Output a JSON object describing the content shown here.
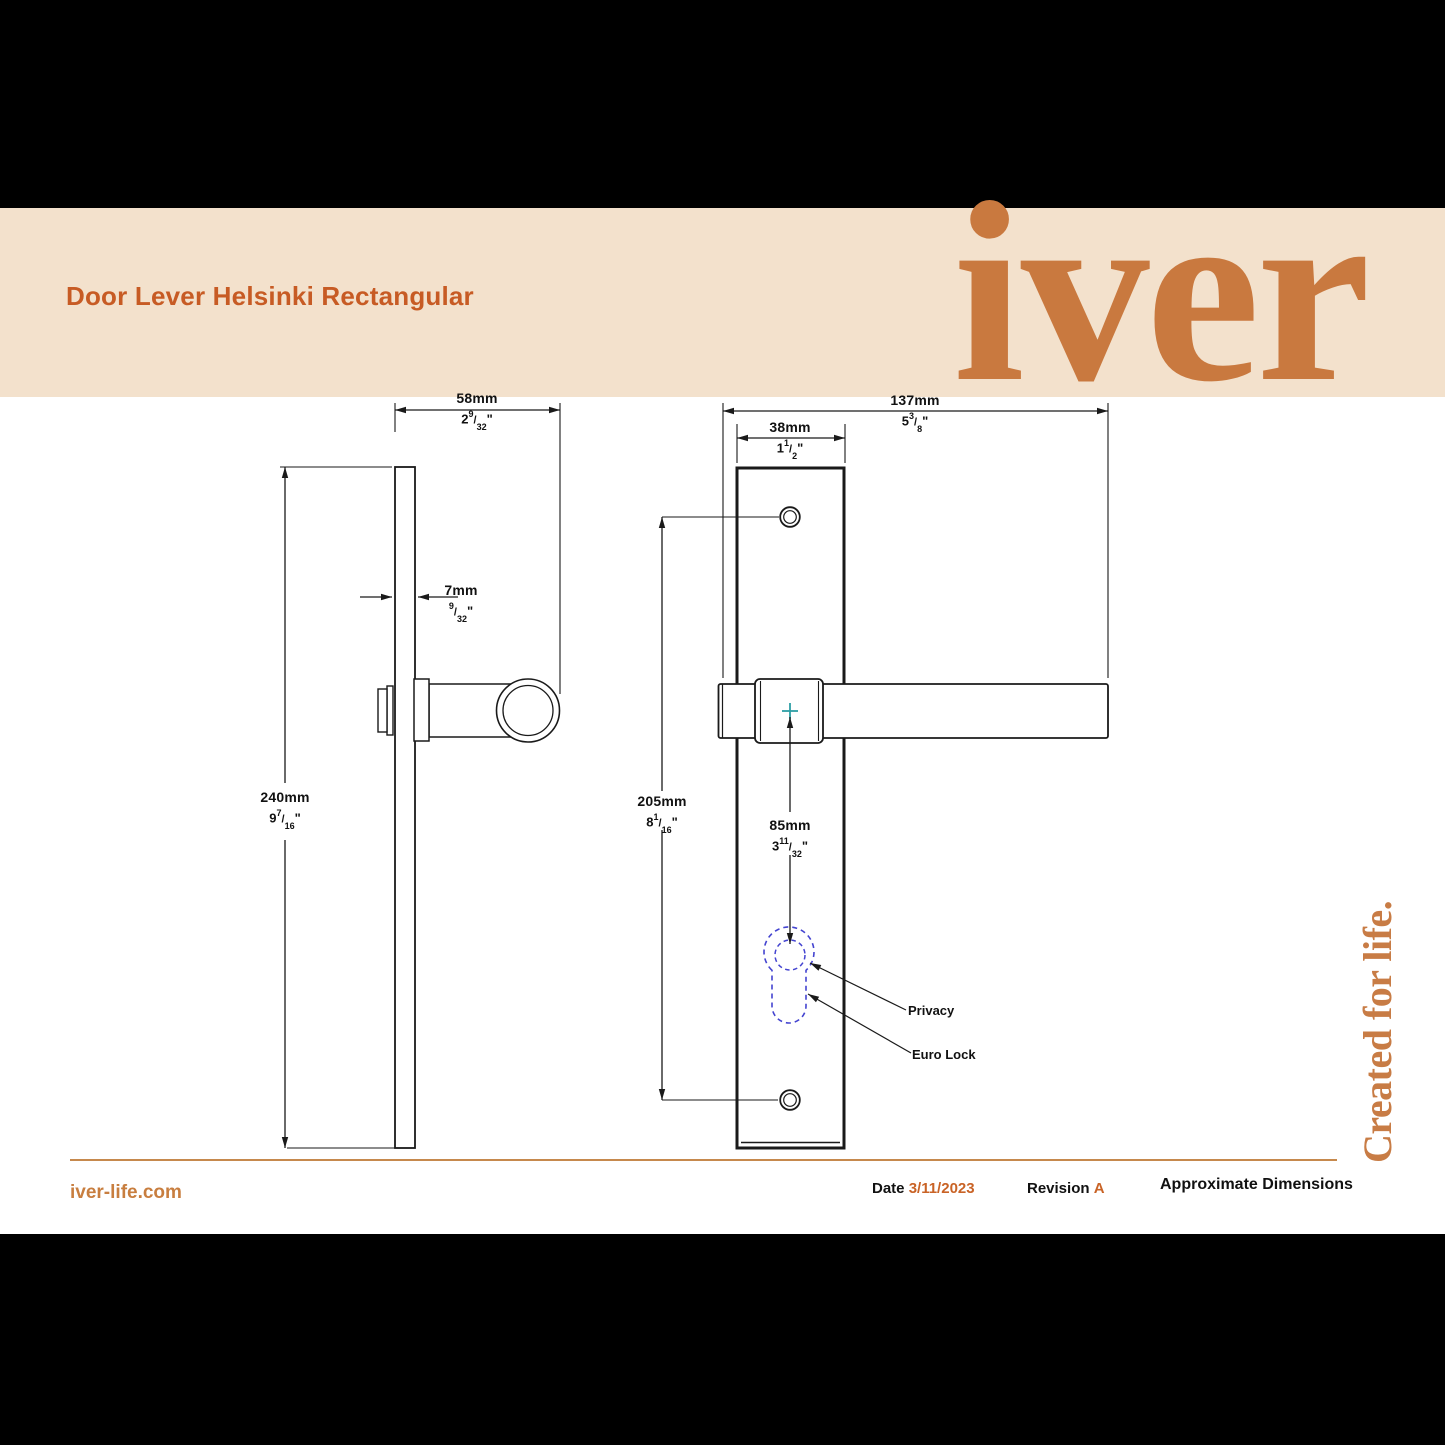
{
  "header": {
    "title": "Door Lever Helsinki Rectangular",
    "logo_text": "iver"
  },
  "marks": {
    "slash": "/",
    "inch": "\""
  },
  "side_view": {
    "projection": {
      "mm": "58mm",
      "in_whole": "2",
      "in_num": "9",
      "in_den": "32"
    },
    "plate_thickness": {
      "mm": "7mm",
      "in_whole": "",
      "in_num": "9",
      "in_den": "32"
    },
    "plate_height": {
      "mm": "240mm",
      "in_whole": "9",
      "in_num": "7",
      "in_den": "16"
    }
  },
  "front_view": {
    "lever_length": {
      "mm": "137mm",
      "in_whole": "5",
      "in_num": "3",
      "in_den": "8"
    },
    "plate_width": {
      "mm": "38mm",
      "in_whole": "1",
      "in_num": "1",
      "in_den": "2"
    },
    "fixing_centres": {
      "mm": "205mm",
      "in_whole": "8",
      "in_num": "1",
      "in_den": "16"
    },
    "lock_centre": {
      "mm": "85mm",
      "in_whole": "3",
      "in_num": "11",
      "in_den": "32"
    },
    "privacy_label": "Privacy",
    "euro_lock_label": "Euro Lock"
  },
  "footer": {
    "website": "iver-life.com",
    "date_label": "Date",
    "date_value": "3/11/2023",
    "revision_label": "Revision",
    "revision_value": "A",
    "note": "Approximate Dimensions",
    "tagline": "Created for life."
  },
  "colors": {
    "brand_orange": "#C9793F",
    "title_orange": "#C75B24",
    "cream_band": "#F3E1CC",
    "rule_orange": "#C6894D",
    "centre_cross_teal": "#2E9FA5",
    "keyhole_blue": "#4444D0"
  }
}
